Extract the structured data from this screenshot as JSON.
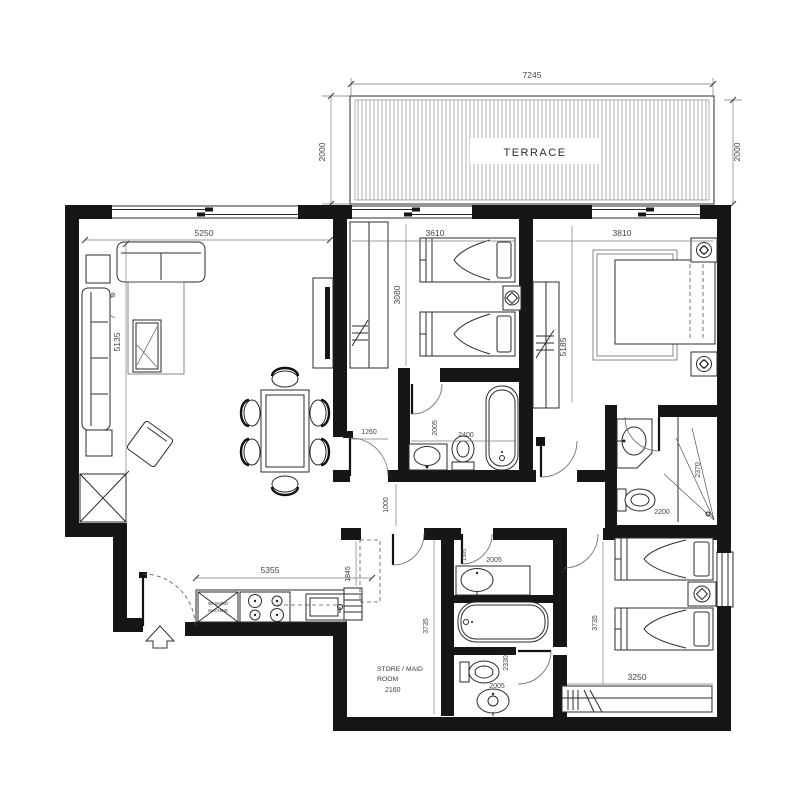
{
  "floorplan": {
    "terrace": {
      "label": "TERRACE",
      "dim_width": "7245",
      "dim_depth_left": "2000",
      "dim_depth_right": "2000"
    },
    "living": {
      "dim_width": "5250",
      "dim_height": "5135"
    },
    "kitchen": {
      "dim_width": "5355",
      "dim_depth": "1845",
      "washing_machine_line1": "WASHING",
      "washing_machine_line2": "MACHINE"
    },
    "bedroom1": {
      "dim_width": "3610",
      "dim_height": "3080"
    },
    "master": {
      "dim_width": "3810",
      "dim_height": "5185"
    },
    "bath1": {
      "dim_width": "2400",
      "dim_height": "2005"
    },
    "hall": {
      "dim_door": "1260",
      "dim_corridor": "1000"
    },
    "ensuite": {
      "dim_width": "2200",
      "dim_height": "2370"
    },
    "store": {
      "label_line1": "STORE / MAID",
      "label_line2": "ROOM",
      "dim_width": "2160",
      "dim_height": "3735"
    },
    "bath2": {
      "dim_top": "2005",
      "dim_door": "1305",
      "dim_height": "2330",
      "dim_bottom": "2005"
    },
    "bedroom2": {
      "dim_width": "3250",
      "dim_height": "3735"
    }
  }
}
